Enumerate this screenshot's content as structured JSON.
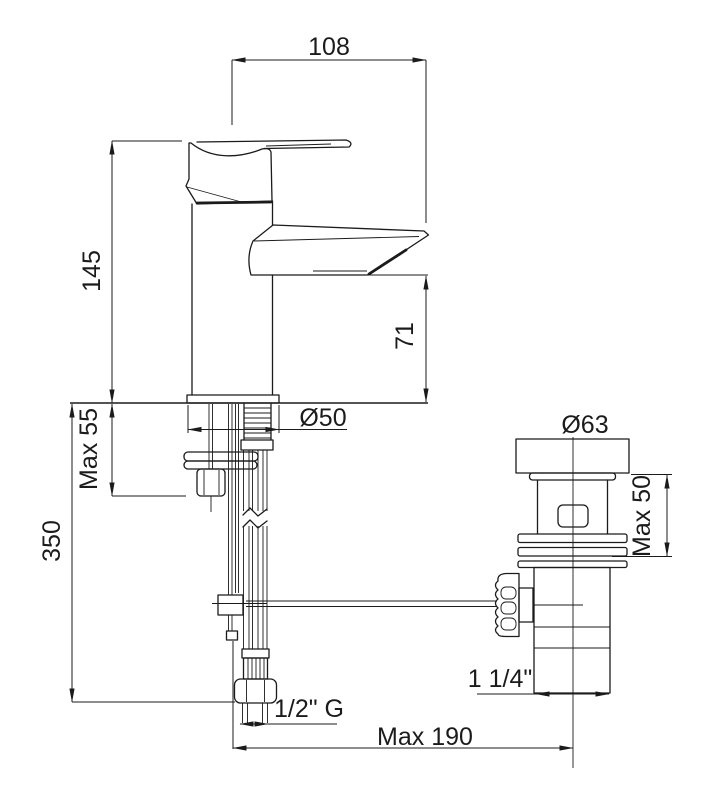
{
  "drawing": {
    "description": "Basin mixer tap with pop-up waste - dimensional technical drawing",
    "background_color": "#ffffff",
    "line_color": "#1b1b1b",
    "dimensions": {
      "spout_reach": "108",
      "total_height": "145",
      "spout_height": "71",
      "max_deck_thickness": "Max 55",
      "supply_length": "350",
      "base_diameter": "Ø50",
      "waste_flange_diameter": "Ø63",
      "waste_max_deck": "Max 50",
      "waste_outlet_size": "1 1/4\"",
      "supply_thread": "1/2\" G",
      "max_waste_distance": "Max 190"
    }
  }
}
